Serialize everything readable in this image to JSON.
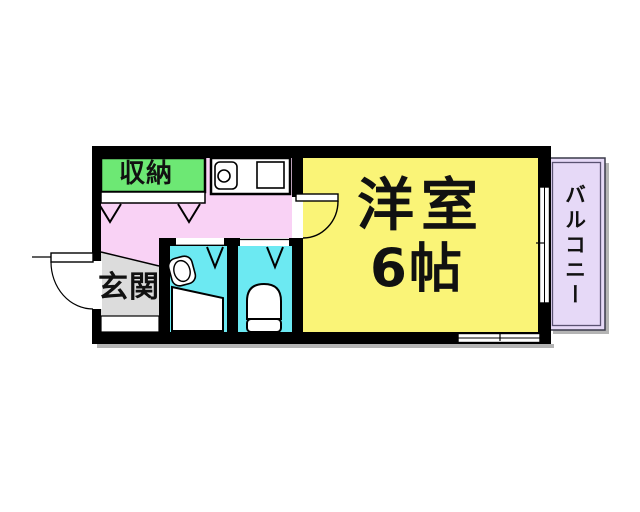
{
  "floor_plan": {
    "labels": {
      "storage": "収納",
      "entrance": "玄関",
      "main_room_name": "洋室",
      "main_room_size": "6帖",
      "balcony": "バルコニー"
    },
    "colors": {
      "storage": "#6de874",
      "hallway": "#f9d2f5",
      "entrance": "#dcdcdc",
      "main_room": "#faf477",
      "wet_rooms": "#6ce9f2",
      "balcony": "#e6d9f7",
      "wall": "#000000",
      "fixture": "#ffffff",
      "shadow": "#b4b4b4"
    }
  }
}
